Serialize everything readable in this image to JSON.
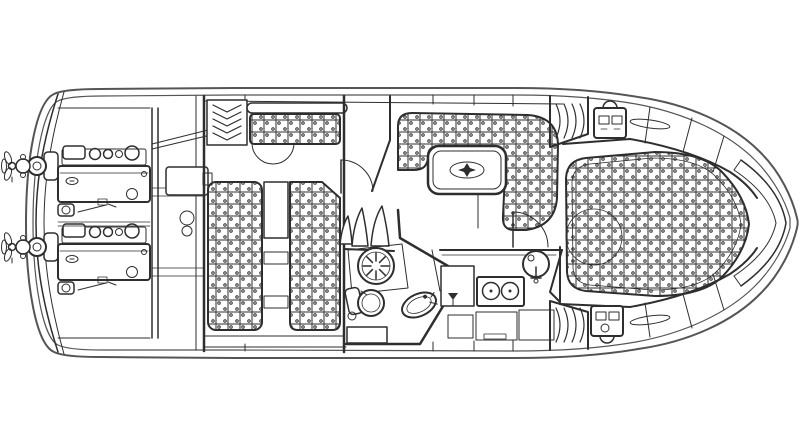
{
  "diagram": {
    "type": "boat-floor-plan",
    "title": "Twin-engine motor yacht interior deck plan, top view, bow to the right",
    "orientation": {
      "bow": "right",
      "stern": "left"
    },
    "colors": {
      "background": "#ffffff",
      "line": "#2e2e2e",
      "line_soft": "#555555",
      "upholstery_dot": "#3a3a3a",
      "fill": "#ffffff"
    },
    "regions": {
      "hull": {
        "label": "hull outline with double sheer line"
      },
      "stern_gear": {
        "label": "twin sterndrives with propellers"
      },
      "engine_room": {
        "label": "engine room with twin engines"
      },
      "aft_cabin": {
        "label": "aft cabin with sofa, hanging locker and twin berths"
      },
      "salon": {
        "label": "salon with U-shaped dinette settee and table"
      },
      "head": {
        "label": "head compartment with shower, toilet and wash basin"
      },
      "galley": {
        "label": "galley with icebox, two-burner stove and sink"
      },
      "bow_cabin": {
        "label": "forward cabin with island berth, lockers and shelves"
      },
      "companionway": {
        "label": "companionway steps"
      }
    },
    "icons": [
      {
        "name": "propeller-icon",
        "meaning": "sterndrive propeller"
      },
      {
        "name": "hanging-locker-icon",
        "meaning": "wardrobe chevron symbol"
      },
      {
        "name": "shower-drain-icon",
        "meaning": "shower sunburst drain"
      },
      {
        "name": "toilet-icon",
        "meaning": "marine toilet"
      },
      {
        "name": "basin-icon",
        "meaning": "oval wash basin with tap"
      },
      {
        "name": "stove-burners-icon",
        "meaning": "two burner rings"
      },
      {
        "name": "sink-faucet-icon",
        "meaning": "round sink with tap"
      },
      {
        "name": "icebox-tap-icon",
        "meaning": "cold box tap symbol"
      },
      {
        "name": "electrical-panel-icon",
        "meaning": "switch / breaker panel"
      },
      {
        "name": "grab-rail-icon",
        "meaning": "oval grab rail"
      },
      {
        "name": "compass-motif-icon",
        "meaning": "table inlay star"
      }
    ]
  }
}
